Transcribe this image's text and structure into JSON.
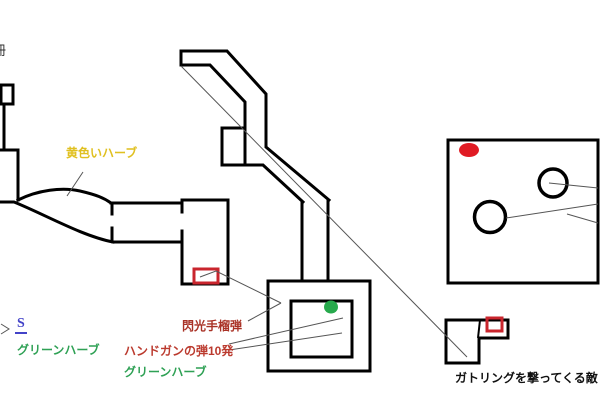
{
  "title": "hand-drawn game map sketch",
  "labels": {
    "partial_kanji": "冊",
    "yellow_herb": "黄色いハーブ",
    "save_point": "S",
    "green_herb_left": "グリーンハーブ",
    "flash_grenade": "閃光手榴弾",
    "handgun_ammo": "ハンドガンの弾10発",
    "green_herb_center": "グリーンハーブ",
    "gatling_enemy": "ガトリングを撃ってくる敵"
  },
  "colors": {
    "map_outline": "#000000",
    "annotation_line": "#555555",
    "yellow_text": "#e0c020",
    "green_text": "#2fa155",
    "red_text": "#bb3a2e",
    "dark_red_text": "#a93226",
    "blue_text": "#4343c8",
    "black_text": "#111111",
    "red_item_box": "#c9252d",
    "red_enemy_ellipse": "#e01b24",
    "green_item_ellipse": "#27a94c"
  },
  "markers": {
    "red_ellipse_room_right": "enemy/red marker in large right room",
    "circles_room_right": 2,
    "green_ellipse_center_room": "green item marker in inner square room",
    "red_box_save_room": "item box near save room",
    "red_box_bottom_right": "item box in gatling enemy room"
  }
}
